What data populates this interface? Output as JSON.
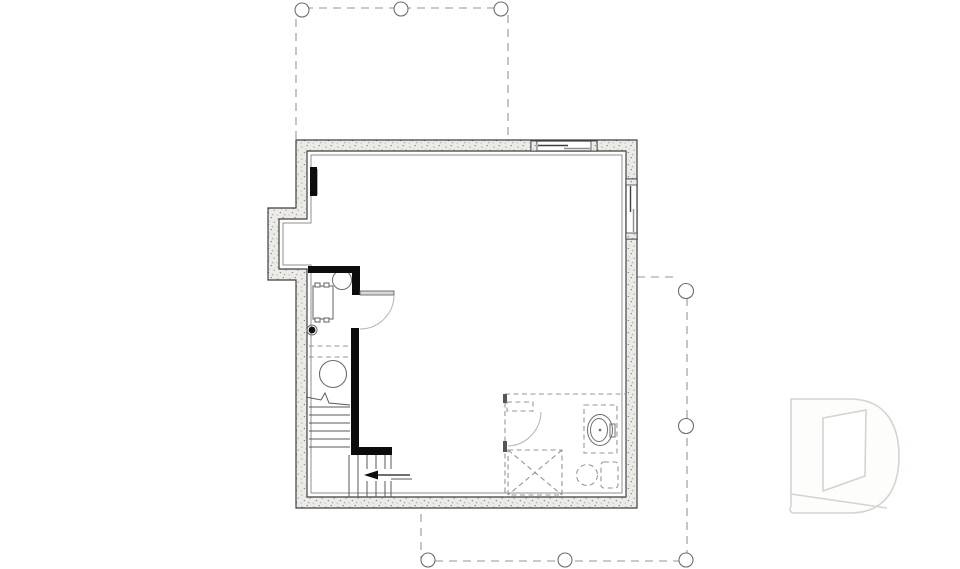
{
  "canvas": {
    "width": 960,
    "height": 569,
    "background": "#ffffff"
  },
  "colors": {
    "wall_line": "#3f3f3f",
    "wall_fill": "#edebe8",
    "wall_speckle": "#b3afa9",
    "wall_speckle_dark": "#8d8a85",
    "framed_wall": "#0c0c0c",
    "furring_line": "#8f8f8f",
    "fixture_line": "#6e6e6e",
    "stair_line": "#5a5a5a",
    "dashed_line": "#969696",
    "light_line": "#b3b3b3",
    "watermark": "#d6d3d0",
    "background": "#ffffff"
  },
  "drawing": {
    "exterior": {
      "windows": [
        "top-wall-window",
        "right-wall-window"
      ],
      "left_wall_bumpout": true
    },
    "decks_dashed": {
      "top_deck_posts": 3,
      "right_side_posts": 2,
      "bottom_deck_posts": 3
    },
    "interior": {
      "framed_walls": "solid-black",
      "utility_room_fixtures": [
        "electrical-panel",
        "water-heater-circle",
        "furnace-with-duct-tabs",
        "floor-drain",
        "pressure-tank-circle"
      ],
      "stairs": {
        "upper_run_treads": 6,
        "lower_run_treads": 5,
        "break_line": true,
        "direction_arrow": "left"
      },
      "doors": [
        "utility-room-door-swing",
        "future-bathroom-door-swing"
      ],
      "future_bathroom_dashed": [
        "shower-with-x",
        "vanity-sink",
        "toilet"
      ]
    },
    "watermark": "d-shaped-builder-logo"
  }
}
